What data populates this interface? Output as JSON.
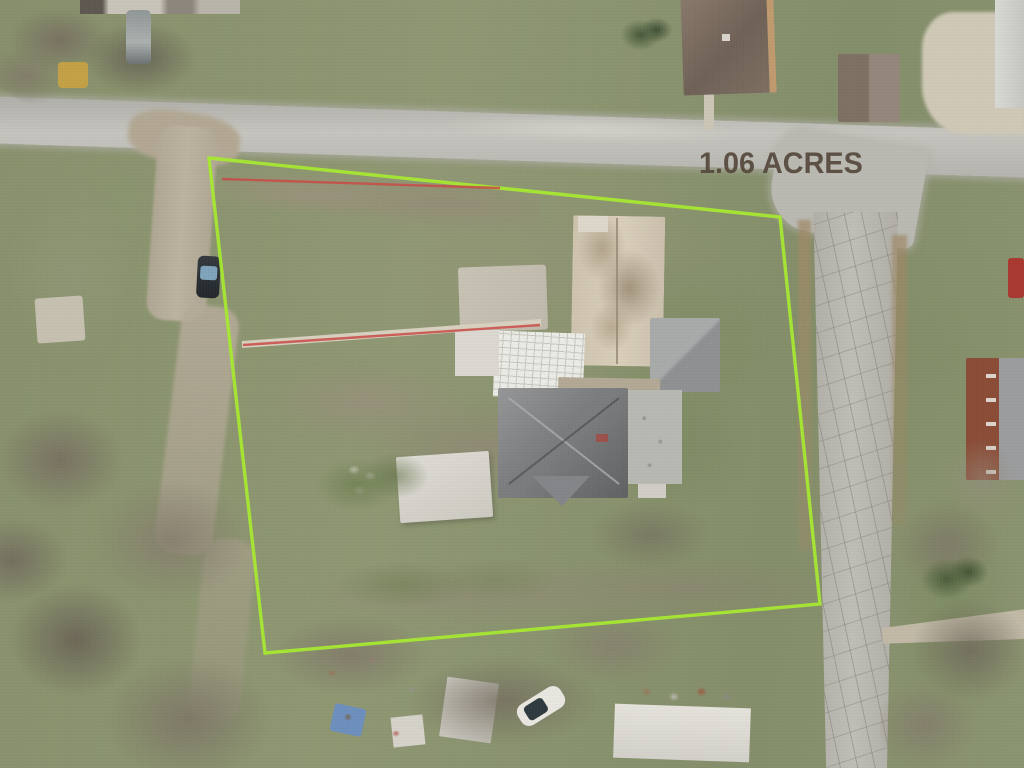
{
  "label": {
    "acreage": "1.06 ACRES"
  },
  "colors": {
    "boundary_line": "#a6e832",
    "measurement_line": "#c94a45",
    "acreage_text": "#55483c"
  },
  "overlay": {
    "boundary_points": "209,158 780,217 820,604 265,653",
    "measure_line_top_points": "222,179 500,188",
    "measure_line_mid_points": "243,345 540,325"
  }
}
